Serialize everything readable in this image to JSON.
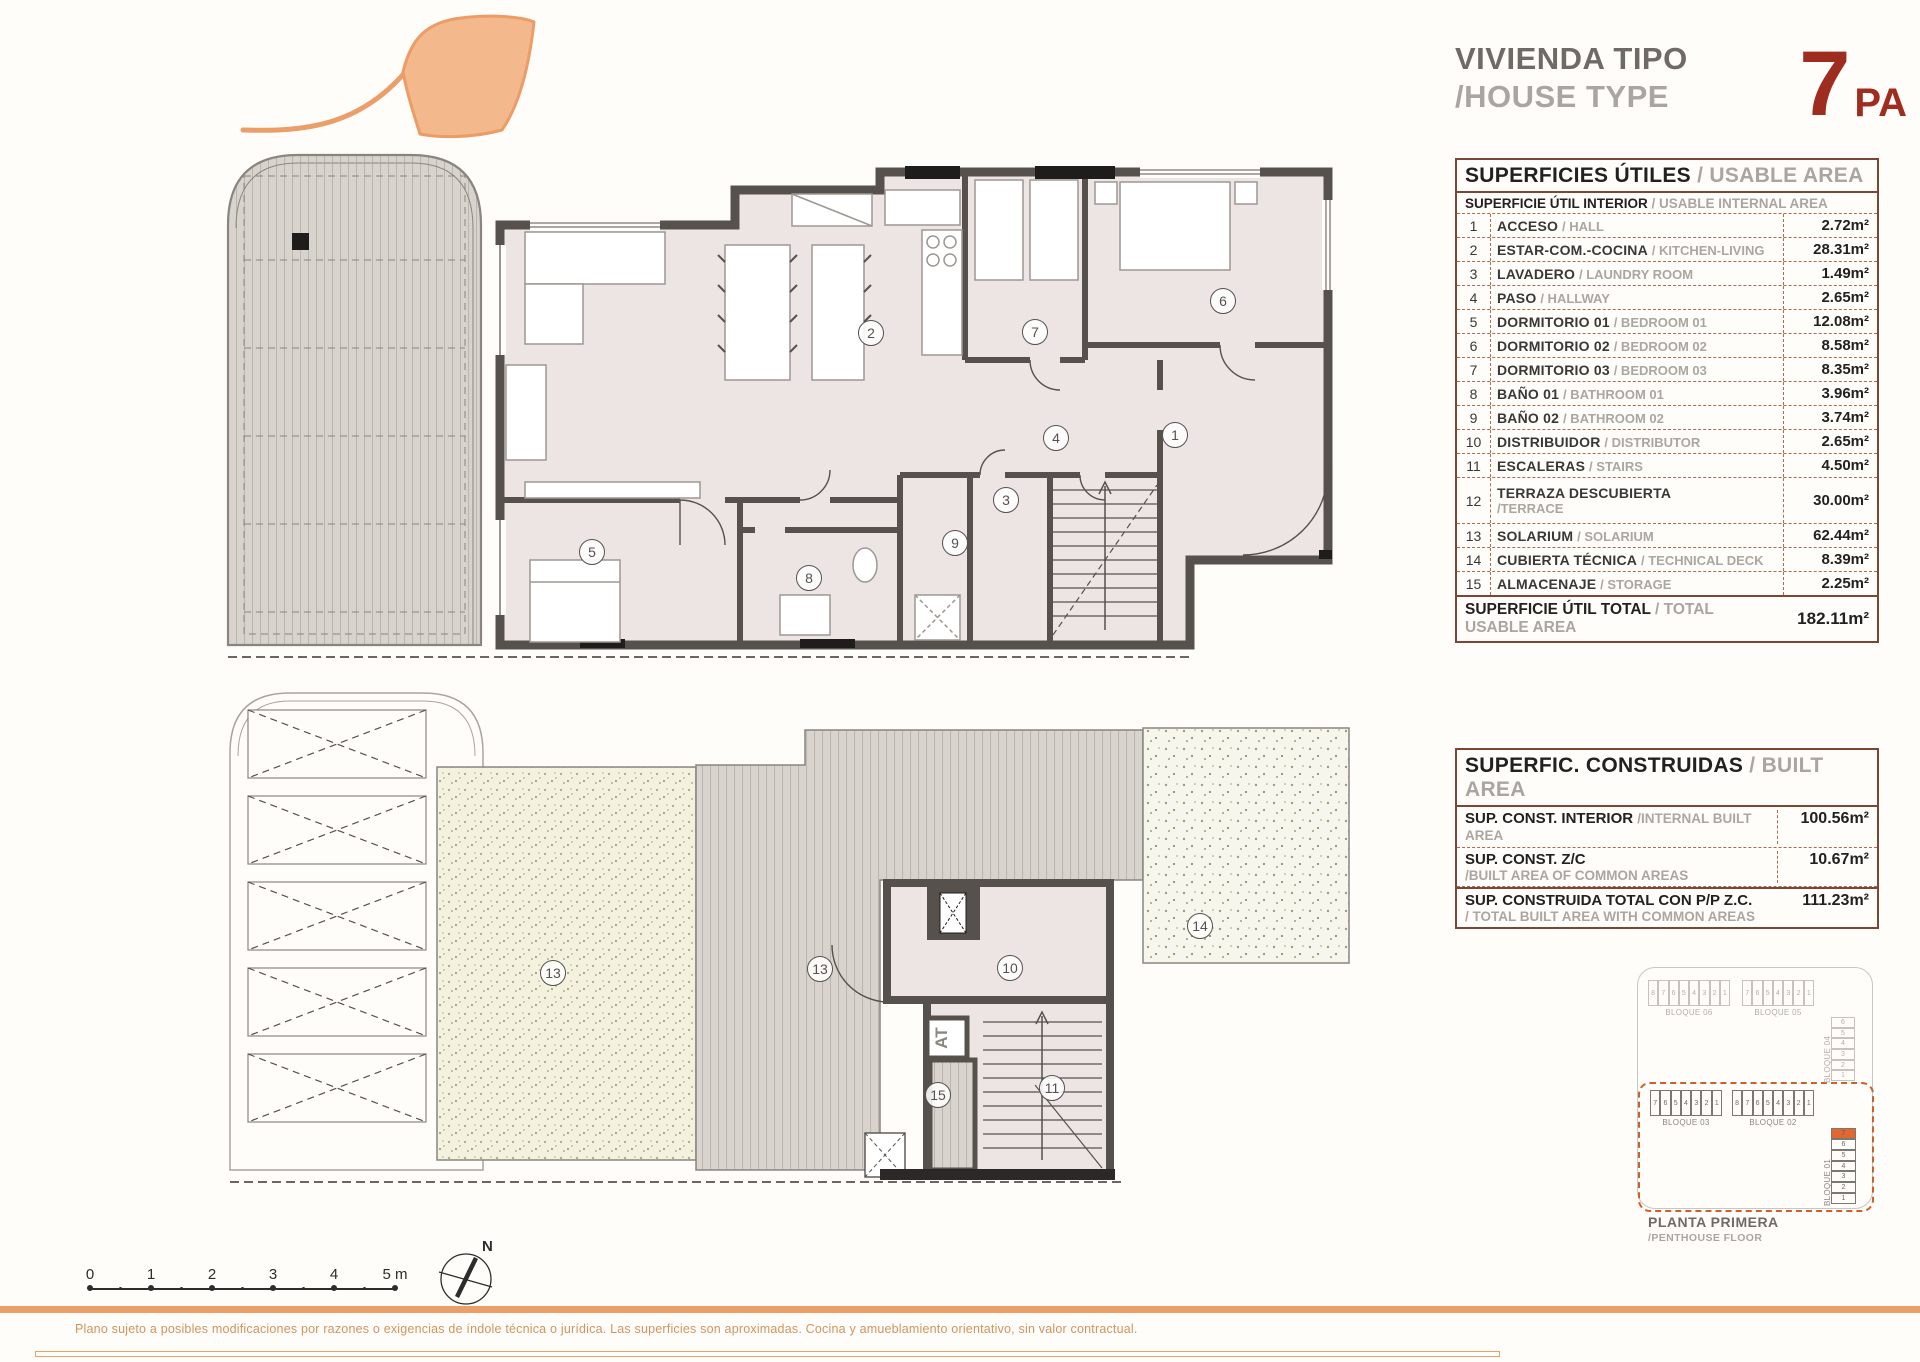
{
  "title": {
    "es": "VIVIENDA TIPO",
    "en": "/HOUSE TYPE",
    "type_number": "7",
    "type_suffix": "PA",
    "accent_color": "#9e2d20"
  },
  "usable_table": {
    "header_es": "SUPERFICIES ÚTILES",
    "header_en": "/ USABLE AREA",
    "subheader_es": "SUPERFICIE ÚTIL INTERIOR",
    "subheader_en": "/ USABLE INTERNAL AREA",
    "rows": [
      {
        "num": "1",
        "es": "ACCESO",
        "en": "/ HALL",
        "value": "2.72m²",
        "two_line": false
      },
      {
        "num": "2",
        "es": "ESTAR-COM.-COCINA",
        "en": "/ KITCHEN-LIVING",
        "value": "28.31m²",
        "two_line": false
      },
      {
        "num": "3",
        "es": "LAVADERO",
        "en": "/ LAUNDRY ROOM",
        "value": "1.49m²",
        "two_line": false
      },
      {
        "num": "4",
        "es": "PASO",
        "en": "/ HALLWAY",
        "value": "2.65m²",
        "two_line": false
      },
      {
        "num": "5",
        "es": "DORMITORIO 01",
        "en": "/ BEDROOM 01",
        "value": "12.08m²",
        "two_line": false
      },
      {
        "num": "6",
        "es": "DORMITORIO 02",
        "en": "/ BEDROOM 02",
        "value": "8.58m²",
        "two_line": false
      },
      {
        "num": "7",
        "es": "DORMITORIO 03",
        "en": "/ BEDROOM 03",
        "value": "8.35m²",
        "two_line": false
      },
      {
        "num": "8",
        "es": "BAÑO 01",
        "en": "/ BATHROOM 01",
        "value": "3.96m²",
        "two_line": false
      },
      {
        "num": "9",
        "es": "BAÑO 02",
        "en": "/ BATHROOM 02",
        "value": "3.74m²",
        "two_line": false
      },
      {
        "num": "10",
        "es": "DISTRIBUIDOR",
        "en": "/ DISTRIBUTOR",
        "value": "2.65m²",
        "two_line": false
      },
      {
        "num": "11",
        "es": "ESCALERAS",
        "en": "/ STAIRS",
        "value": "4.50m²",
        "two_line": false
      },
      {
        "num": "12",
        "es": "TERRAZA DESCUBIERTA",
        "en": "/TERRACE",
        "value": "30.00m²",
        "two_line": true
      },
      {
        "num": "13",
        "es": "SOLARIUM",
        "en": "/ SOLARIUM",
        "value": "62.44m²",
        "two_line": false
      },
      {
        "num": "14",
        "es": "CUBIERTA TÉCNICA",
        "en": "/ TECHNICAL DECK",
        "value": "8.39m²",
        "two_line": false
      },
      {
        "num": "15",
        "es": "ALMACENAJE",
        "en": "/ STORAGE",
        "value": "2.25m²",
        "two_line": false
      }
    ],
    "total_es": "SUPERFICIE ÚTIL TOTAL",
    "total_en": "/ TOTAL USABLE AREA",
    "total_value": "182.11m²"
  },
  "built_table": {
    "header_es": "SUPERFIC. CONSTRUIDAS",
    "header_en": "/ BUILT AREA",
    "rows": [
      {
        "es": "SUP. CONST. INTERIOR",
        "en": "/INTERNAL BUILT AREA",
        "value": "100.56m²",
        "two_line": false,
        "solid": false
      },
      {
        "es": "SUP. CONST. Z/C",
        "en": "/BUILT AREA OF COMMON AREAS",
        "value": "10.67m²",
        "two_line": true,
        "solid": false
      },
      {
        "es": "SUP. CONSTRUIDA TOTAL CON P/P Z.C.",
        "en": "/ TOTAL BUILT AREA WITH COMMON AREAS",
        "value": "111.23m²",
        "two_line": true,
        "solid": true
      }
    ]
  },
  "plan_upper": {
    "labels": [
      {
        "t": "2",
        "x": 691,
        "y": 203
      },
      {
        "t": "7",
        "x": 855,
        "y": 202
      },
      {
        "t": "6",
        "x": 1043,
        "y": 171
      },
      {
        "t": "1",
        "x": 995,
        "y": 305
      },
      {
        "t": "4",
        "x": 876,
        "y": 308
      },
      {
        "t": "3",
        "x": 826,
        "y": 370
      },
      {
        "t": "9",
        "x": 775,
        "y": 413
      },
      {
        "t": "8",
        "x": 629,
        "y": 448
      },
      {
        "t": "5",
        "x": 412,
        "y": 422
      }
    ]
  },
  "plan_lower": {
    "labels": [
      {
        "t": "13",
        "x": 363,
        "y": 283
      },
      {
        "t": "13",
        "x": 630,
        "y": 279
      },
      {
        "t": "14",
        "x": 1010,
        "y": 236
      },
      {
        "t": "10",
        "x": 820,
        "y": 278
      },
      {
        "t": "11",
        "x": 862,
        "y": 398
      },
      {
        "t": "15",
        "x": 748,
        "y": 405
      }
    ],
    "lift_label": "AT"
  },
  "block_diagram": {
    "blocks": [
      {
        "label": "BLOQUE 06",
        "units": [
          "8",
          "7",
          "6",
          "5",
          "4",
          "3",
          "2",
          "1"
        ],
        "x": 20,
        "y": 18,
        "w": 82,
        "h": 26,
        "dir": "h",
        "zone": "out",
        "highlight": -1
      },
      {
        "label": "BLOQUE 05",
        "units": [
          "7",
          "6",
          "5",
          "4",
          "3",
          "2",
          "1"
        ],
        "x": 114,
        "y": 18,
        "w": 72,
        "h": 26,
        "dir": "h",
        "zone": "out",
        "highlight": -1
      },
      {
        "label": "BLOQUE 04",
        "units": [
          "6",
          "5",
          "4",
          "3",
          "2",
          "1"
        ],
        "x": 203,
        "y": 55,
        "w": 24,
        "h": 64,
        "dir": "v",
        "zone": "out",
        "highlight": -1
      },
      {
        "label": "BLOQUE 03",
        "units": [
          "7",
          "6",
          "5",
          "4",
          "3",
          "2",
          "1"
        ],
        "x": 22,
        "y": 128,
        "w": 72,
        "h": 26,
        "dir": "h",
        "zone": "in",
        "highlight": -1
      },
      {
        "label": "BLOQUE 02",
        "units": [
          "8",
          "7",
          "6",
          "5",
          "4",
          "3",
          "2",
          "1"
        ],
        "x": 104,
        "y": 128,
        "w": 82,
        "h": 26,
        "dir": "h",
        "zone": "in",
        "highlight": -1
      },
      {
        "label": "BLOQUE 01",
        "units": [
          "7",
          "6",
          "5",
          "4",
          "3",
          "2",
          "1"
        ],
        "x": 203,
        "y": 166,
        "w": 25,
        "h": 76,
        "dir": "v",
        "zone": "in",
        "highlight": 0
      }
    ],
    "highlight_color": "#e1662f",
    "caption_es": "PLANTA PRIMERA",
    "caption_en": "/PENTHOUSE FLOOR"
  },
  "scale_bar": {
    "tick_labels": [
      "0",
      "1",
      "2",
      "3",
      "4"
    ],
    "last_label": "5 m"
  },
  "north": {
    "label": "N"
  },
  "footer": {
    "disclaimer": "Plano sujeto a posibles modificaciones por razones o exigencias de índole técnica o jurídica. Las superficies son aproximadas. Cocina y amueblamiento orientativo, sin valor contractual."
  }
}
